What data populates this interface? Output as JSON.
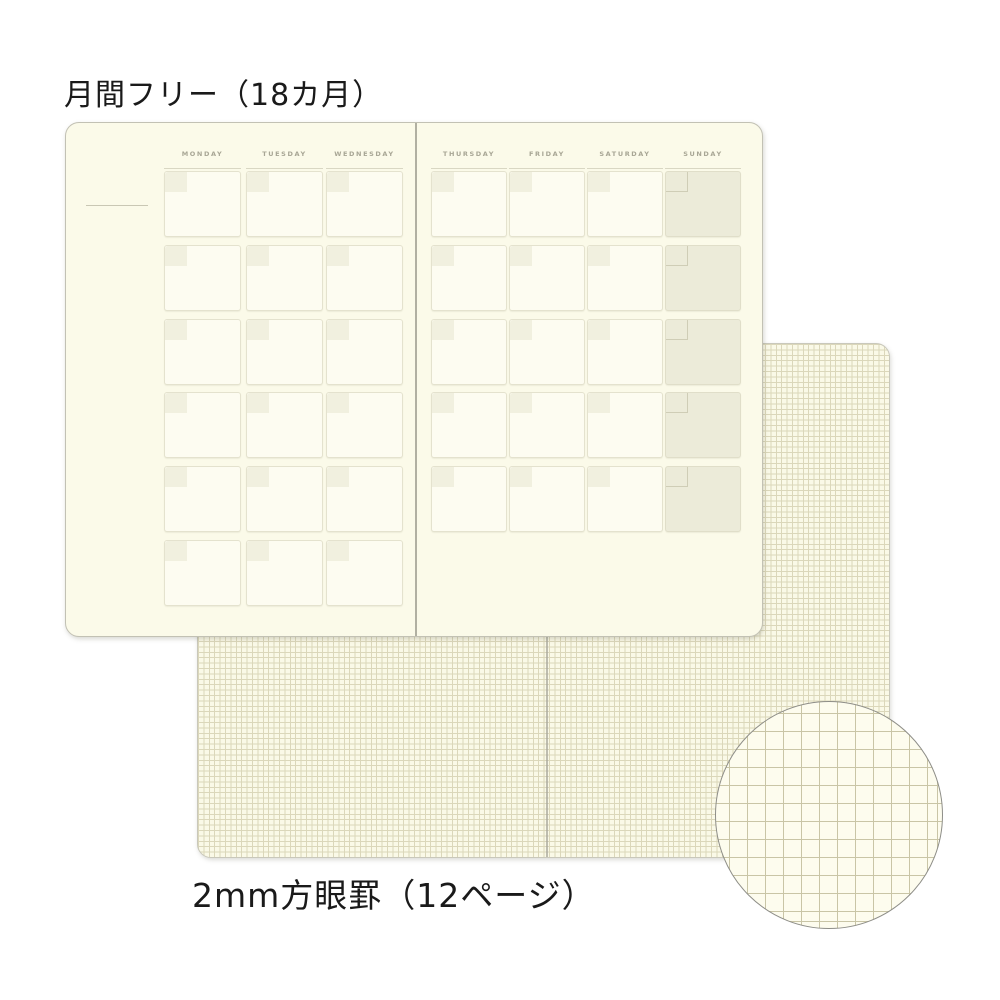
{
  "labels": {
    "top_title": "月間フリー（18カ月）",
    "bottom_title": "2mm方眼罫（12ページ）"
  },
  "calendar": {
    "left_page": {
      "days": [
        "MONDAY",
        "TUESDAY",
        "WEDNESDAY"
      ],
      "rows": 6
    },
    "right_page": {
      "days": [
        "THURSDAY",
        "FRIDAY",
        "SATURDAY",
        "SUNDAY"
      ],
      "rows": 5,
      "shaded_day": "SUNDAY"
    }
  },
  "grid_paper": {
    "grid_spacing_px": 5.4,
    "magnified_grid_spacing_px": 18
  },
  "colors": {
    "page_cream": "#FBFAE9",
    "grid_page_cream": "#FAF9E7",
    "cell_fill": "#FDFCF1",
    "cell_border": "#E4E2CE",
    "corner_square_fill": "#F1F0DF",
    "sunday_cell_fill": "#ECEBD9",
    "sunday_square_border": "#CFCDB6",
    "day_label_text": "#A8A695",
    "grid_line": "#DBD7BA",
    "magnified_grid_line": "#C9C5A6",
    "fold_line": "#B1B0A2",
    "circle_border": "#8E8E88",
    "title_text": "#1A1A1A"
  }
}
